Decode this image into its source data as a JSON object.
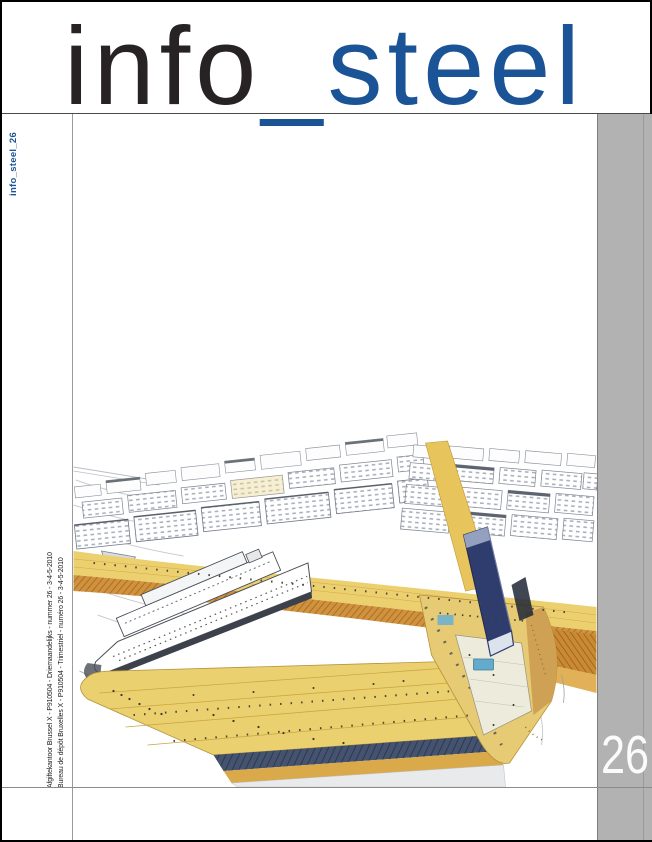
{
  "masthead": {
    "title_black": "info",
    "title_blue": "_steel"
  },
  "spine": {
    "label": "info_steel_26"
  },
  "imprint": {
    "line1": "Afgiftekantoor Brussel X - P910504 - Driemaandelijks - nummer 26 - 3-4-5-2010",
    "line2": "Bureau de dépôt Bruxelles X - P910504 - Trimestriel - numéro 26 - 3-4-5-2010"
  },
  "issue_badge": {
    "number": "26"
  },
  "colors": {
    "accent_blue": "#1a5396",
    "title_black": "#272324",
    "band_gray": "#b2b2b2",
    "badge_text": "#ffffff"
  }
}
